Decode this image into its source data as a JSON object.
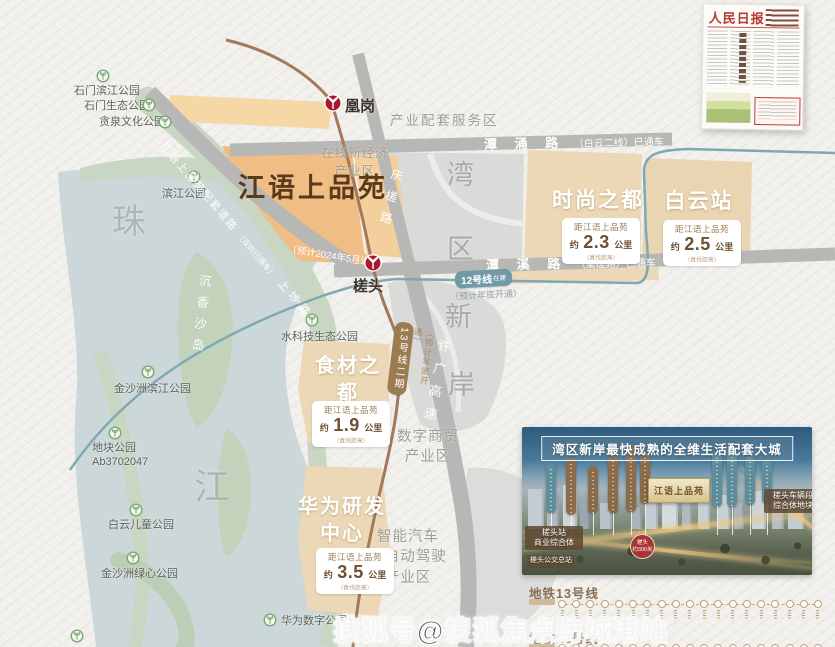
{
  "map": {
    "project_title": "江语上品苑",
    "parks": [
      {
        "label": "石门滨江公园"
      },
      {
        "label": "石门生态公园"
      },
      {
        "label": "贪泉文化公园"
      },
      {
        "label": "滨江公园"
      },
      {
        "label": "水科技生态公园"
      },
      {
        "label": "金沙洲滨江公园"
      },
      {
        "label": "地块公园\nAb3702047"
      },
      {
        "label": "白云儿童公园"
      },
      {
        "label": "金沙洲绿心公园"
      },
      {
        "label": "华为数字公园"
      }
    ],
    "geo": {
      "zhu": "珠",
      "jiang": "江",
      "wan": "湾",
      "qu": "区",
      "xin": "新",
      "an": "岸",
      "island": "沉香沙岛"
    },
    "roads": {
      "tanyong_name": "潭 涌 路",
      "tanyong_status": "（白云二线）已通车",
      "tanxi_name": "潭 溪 路",
      "tanxi_status": "（棠槎路）已通车",
      "qingcha": "庆槎路",
      "xuguang": "许广高速",
      "peitao_name": "江语上品苑配套道路",
      "peitao_note": "（双向已通车）",
      "peitao_alias": "上埗路",
      "opening_2024": "（预计2024年5月通车）"
    },
    "metro": {
      "station_huanggang": "凰岗",
      "station_chatou": "槎头",
      "line12_badge": "12号线",
      "line12_tag": "在建",
      "line12_note": "（预计年底开通）",
      "line13_badge": "13号线二期",
      "line13_note": "（预计年底开通）"
    },
    "zones": {
      "service": "产业配套服务区",
      "online": "在线新经济\n产业区",
      "digital": "数字商贸\n产业区",
      "smartcar": "智能汽车\n及自动驾驶\n产业区"
    },
    "blocks": [
      {
        "name": "时尚之都",
        "prefix": "距江语上品苑",
        "approx": "约",
        "value": "2.3",
        "unit": "公里",
        "note": "（直线距离）"
      },
      {
        "name": "白云站",
        "prefix": "距江语上品苑",
        "approx": "约",
        "value": "2.5",
        "unit": "公里",
        "note": "（直线距离）"
      },
      {
        "name": "食材之都",
        "prefix": "距江语上品苑",
        "approx": "约",
        "value": "1.9",
        "unit": "公里",
        "note": "（直线距离）"
      },
      {
        "name": "华为研发中心",
        "prefix": "距江语上品苑",
        "approx": "约",
        "value": "3.5",
        "unit": "公里",
        "note": "（直线距离）"
      }
    ]
  },
  "newspaper": {
    "masthead": "人民日报"
  },
  "panel": {
    "title": "湾区新岸最快成熟的全维生活配套大城",
    "plaque": "江语上品苑",
    "label_left": "槎头站\n商业综合体",
    "label_bus": "槎头公交总站",
    "label_right": "槎头车辆段\n综合体地块",
    "badge": "槎头\n约300米"
  },
  "legend": {
    "line13": "地铁13号线",
    "line12": "地铁12号线"
  },
  "watermark": "搜狐号@搜狐焦点防城港站",
  "colors": {
    "metro_red": "#a6192e",
    "line12": "#6f9aa6",
    "line13": "#9c7a52",
    "block_orange": "#f0bd84",
    "block_tan": "#ecd8b6",
    "water": "#ccd7d9"
  }
}
